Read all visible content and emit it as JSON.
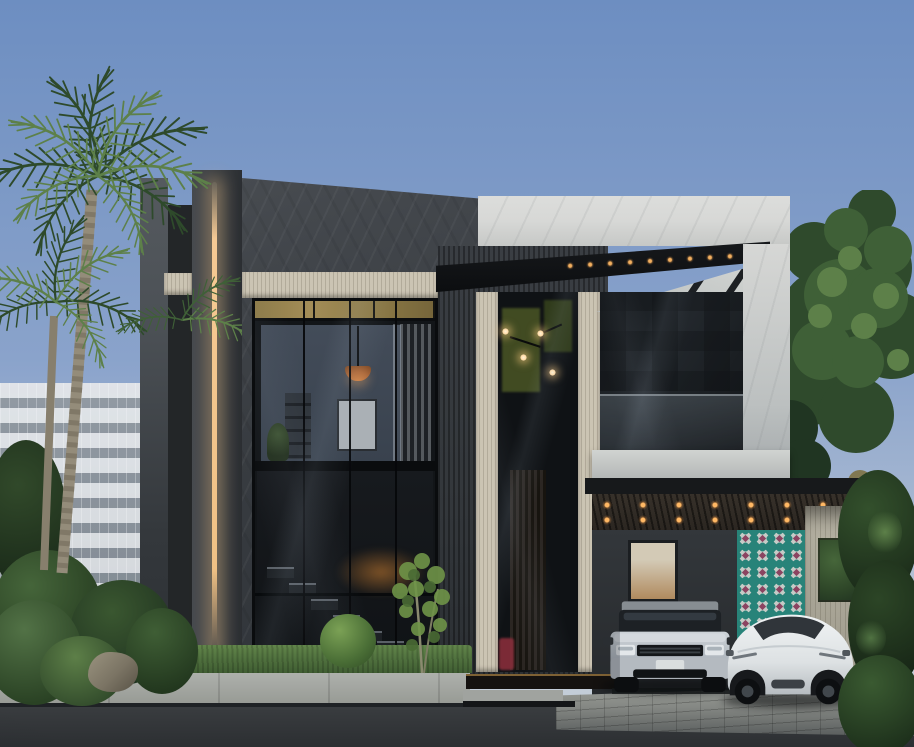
{
  "meta": {
    "scene": "Modern two-storey luxury villa exterior, daytime architectural rendering",
    "elements": [
      "clear-blue-sky",
      "neighboring-glass-building",
      "palm-trees",
      "dark-stone-facade",
      "vertical-led-accent-light",
      "travertine-bands",
      "double-height-glass-wall-with-staircase",
      "upper-lounge-with-copper-pendant",
      "entry-bay-with-chandelier",
      "black-canopy",
      "white-marble-volume",
      "balcony-smoked-glass",
      "carport-wood-slat-ceiling-with-spotlights",
      "teal-patterned-tile-wall",
      "light-wood-screen-wall",
      "silver-range-rover-suv",
      "white-tesla-model-y",
      "paver-driveway",
      "concrete-sidewalk",
      "asphalt-road",
      "boxwood-hedges",
      "garden-rock",
      "ornamental-tree"
    ]
  },
  "palette": {
    "sky_top": "#6d8ec1",
    "sky_mid": "#8aa3cb",
    "sky_horizon": "#c3cdd8",
    "bg_building": "#c9ced2",
    "facade_dark": "#393d42",
    "facade_darker": "#232628",
    "facade_light": "#4b5055",
    "marble_light": "#d7d8d6",
    "marble_shadow": "#a3a8aa",
    "travertine": "#cbc4b3",
    "travertine_dark": "#b2ab9a",
    "wood_dark": "#33373b",
    "gold_transom": "#a38d58",
    "led_glow": "#f5c994",
    "glass_dark": "#121518",
    "glass_mid": "#22272c",
    "interior_wall": "#434c59",
    "copper_lamp": "#b06a3a",
    "interior_warm": "#b08a5e",
    "interior_green": "#4e5a26",
    "chandelier": "#ffd9a2",
    "red_accent": "#8e2f3c",
    "teal_tile": "#2f9a8f",
    "tile_white": "#eef3ee",
    "tile_magenta": "#a84d72",
    "wood_wall": "#b6b2a3",
    "carport_ceiling": "#37312a",
    "carport_light": "#ffb864",
    "foliage_dark": "#1f3120",
    "foliage_mid": "#3b5a33",
    "foliage_light": "#6c9150",
    "palm_dark": "#2e4a2b",
    "palm_light": "#5d8049",
    "trunk": "#948c7a",
    "grass": "#3f5d32",
    "sidewalk": "#969993",
    "paver": "#848783",
    "paver_dark": "#5a5e5e",
    "road": "#3b3e41",
    "road_dark": "#2c2f32",
    "curb": "#1f2225",
    "rock": "#7b7464",
    "car_silver": "#c8ced3",
    "car_silver_dark": "#9ba2a9",
    "car_glass": "#1d2125",
    "car_white": "#e8ebec",
    "car_white_shadow": "#b6bcc0",
    "tire": "#0d0f11"
  }
}
